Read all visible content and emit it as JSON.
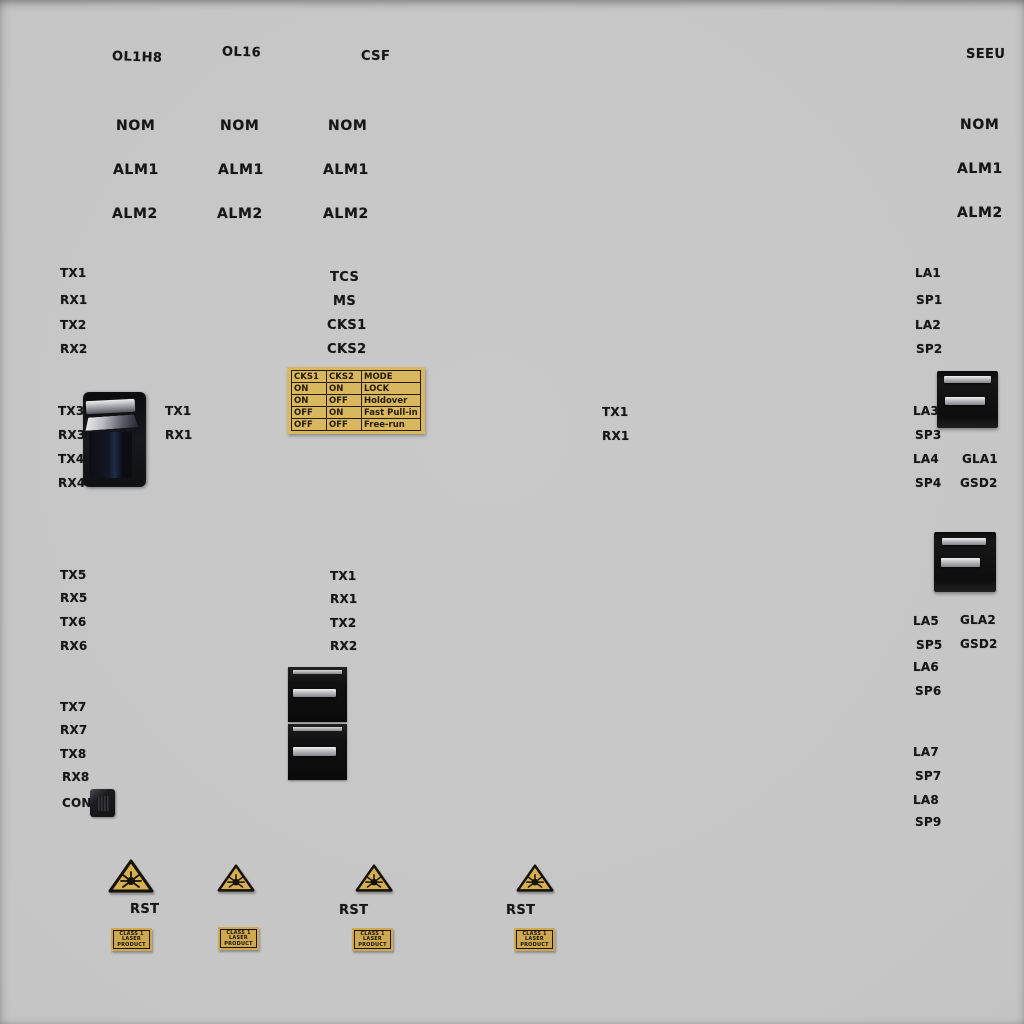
{
  "cards": {
    "ol1h8": "OL1H8",
    "ol16": "OL16",
    "csf": "CSF",
    "seeu": "SEEU"
  },
  "status": {
    "nom": "NOM",
    "alm1": "ALM1",
    "alm2": "ALM2"
  },
  "ports": {
    "tx1": "TX1",
    "rx1": "RX1",
    "tx2": "TX2",
    "rx2": "RX2",
    "tx3": "TX3",
    "rx3": "RX3",
    "tx4": "TX4",
    "rx4": "RX4",
    "tx5": "TX5",
    "rx5": "RX5",
    "tx6": "TX6",
    "rx6": "RX6",
    "tx7": "TX7",
    "rx7": "RX7",
    "tx8": "TX8",
    "rx8": "RX8",
    "con": "CON"
  },
  "sync": {
    "tcs": "TCS",
    "ms": "MS",
    "cks1": "CKS1",
    "cks2": "CKS2"
  },
  "right_ports": {
    "la1": "LA1",
    "sp1": "SP1",
    "la2": "LA2",
    "sp2": "SP2",
    "la3": "LA3",
    "sp3": "SP3",
    "la4": "LA4",
    "sp4": "SP4",
    "la5": "LA5",
    "sp5": "SP5",
    "la6": "LA6",
    "sp6": "SP6",
    "la7": "LA7",
    "sp7": "SP7",
    "la8": "LA8",
    "sp9": "SP9",
    "gla1": "GLA1",
    "gla2": "GLA2",
    "gsd2": "GSD2"
  },
  "mode_table": {
    "headers": [
      "CKS1",
      "CKS2",
      "MODE"
    ],
    "rows": [
      [
        "ON",
        "ON",
        "LOCK"
      ],
      [
        "ON",
        "OFF",
        "Holdover"
      ],
      [
        "OFF",
        "ON",
        "Fast Pull-in"
      ],
      [
        "OFF",
        "OFF",
        "Free-run"
      ]
    ]
  },
  "reset": {
    "rst": "RST"
  },
  "laser_label": {
    "line1": "CLASS 1",
    "line2": "LASER",
    "line3": "PRODUCT"
  },
  "colors": {
    "panel_bg": "#c6c6c6",
    "sticker_gold": "#d3ab55",
    "text": "#161616",
    "connector_dark": "#101013"
  }
}
